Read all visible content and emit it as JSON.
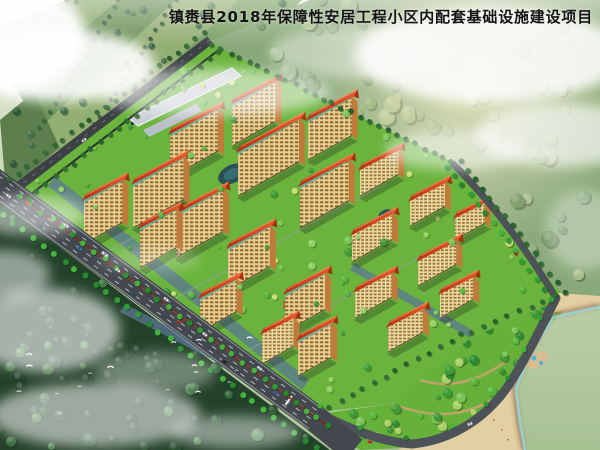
{
  "header": {
    "title": "镇赉县2018年保障性安居工程小区内配套基础设施建设项目"
  },
  "palette": {
    "title_text": "#141414",
    "base_sky": "#cfdcc0",
    "farm_green": "#7ba064",
    "farm_dark": "#5c7f4d",
    "forest_dark": "#24422a",
    "forest_right": "#8aa97a",
    "grass": "#6ab33c",
    "orchard": "#97c35e",
    "park": "#66b13a",
    "road_main": "#42484d",
    "road_minor": "#4c5257",
    "road_top": "#3b4145",
    "lane_marking": "#e9ebe8",
    "facade": "#e9c87d",
    "facade_side": "#c07a3a",
    "roof_red": "#c43718",
    "roof_light": "#ef6030",
    "paving_blue": "#5b7795",
    "concrete_roof": "#c9ced4",
    "pond": "#2b5056",
    "sea_deep": "#1d84ad",
    "sea_shallow": "#7fd6e4",
    "sand": "#e2cfa2",
    "sand_wet": "#b3765a",
    "tree_bright": "#45b23b",
    "tree_dark": "#2d6b33",
    "mist": "#ffffff",
    "wall_red": "#7a2f1e"
  }
}
